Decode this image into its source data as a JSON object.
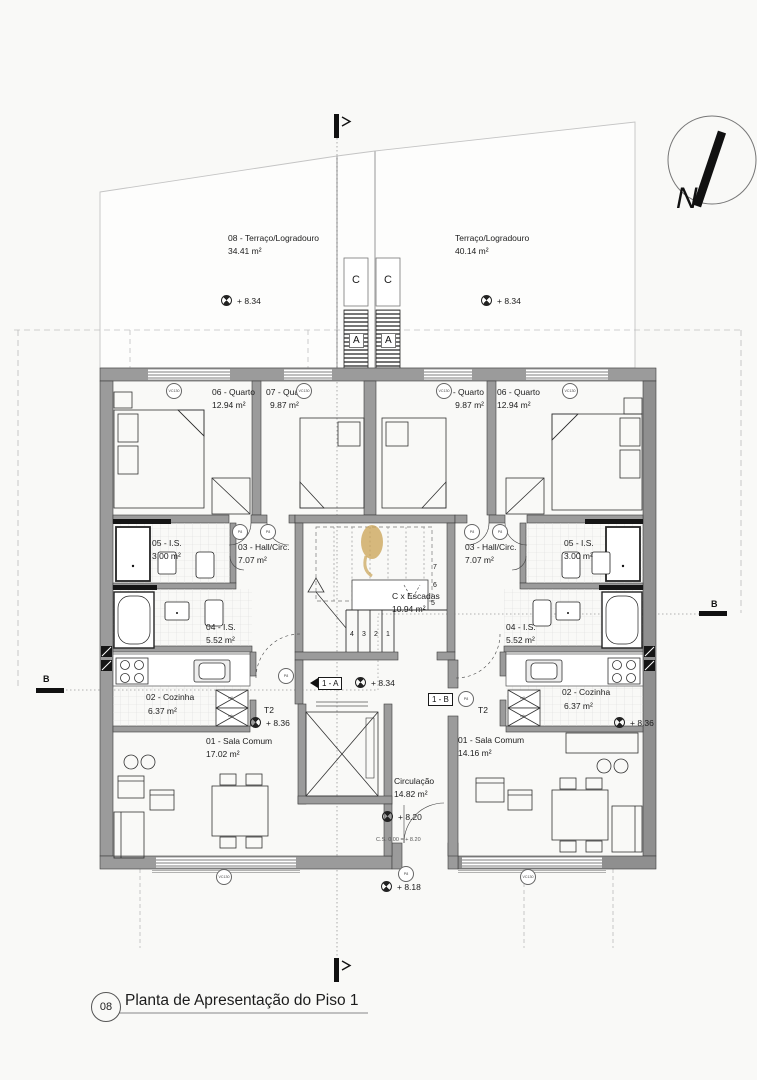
{
  "colors": {
    "wall": "#9b9b9b",
    "wall_dark": "#858585",
    "line": "#222222",
    "light": "#c4c4c4",
    "watermark": "#c9a253",
    "bg": "#f9f9f7"
  },
  "title_block": {
    "number": "08",
    "title": "Planta de Apresentação do Piso 1"
  },
  "north": {
    "label": "N"
  },
  "terraces": {
    "left": {
      "name": "08 - Terraço/Logradouro",
      "area": "34.41 m²",
      "elevation": "+ 8.34"
    },
    "right": {
      "name": "Terraço/Logradouro",
      "area": "40.14 m²",
      "elevation": "+ 8.34"
    }
  },
  "core": {
    "shaft_left": "C",
    "shaft_right": "C",
    "duct_left": "A",
    "duct_right": "A",
    "stairs": {
      "name": "C x Escadas",
      "area": "10.94 m²",
      "steps_bottom": [
        "4",
        "3",
        "2",
        "1"
      ],
      "steps_right": [
        "7",
        "6",
        "5"
      ]
    },
    "landing": {
      "label_a": "1 - A",
      "elevation": "+ 8.34",
      "label_b": "1 - B"
    },
    "circulation": {
      "name": "Circulação",
      "area": "14.82 m²",
      "elevation": "+ 8.20",
      "note": "C.S. 0.00 = + 8.20"
    },
    "outside_elevation": "+ 8.18"
  },
  "unit_left": {
    "type": "T2",
    "entry_elevation": "+ 8.36",
    "rooms": {
      "bedroom1": {
        "name": "06 - Quarto",
        "area": "12.94 m²"
      },
      "bedroom2": {
        "name": "07 - Quarto",
        "area": "9.87 m²"
      },
      "wc_small": {
        "name": "05 - I.S.",
        "area": "3.00 m²"
      },
      "hall": {
        "name": "03 - Hall/Circ.",
        "area": "7.07 m²"
      },
      "wc_main": {
        "name": "04 - I.S.",
        "area": "5.52 m²"
      },
      "kitchen": {
        "name": "02 - Cozinha",
        "area": "6.37 m²"
      },
      "living": {
        "name": "01 - Sala Comum",
        "area": "17.02 m²"
      }
    }
  },
  "unit_right": {
    "type": "T2",
    "entry_elevation": "+ 8.36",
    "rooms": {
      "bedroom1": {
        "name": "06 - Quarto",
        "area": "12.94 m²"
      },
      "bedroom2": {
        "name": "07 - Quarto",
        "area": "9.87 m²"
      },
      "wc_small": {
        "name": "05 - I.S.",
        "area": "3.00 m²"
      },
      "hall": {
        "name": "03 - Hall/Circ.",
        "area": "7.07 m²"
      },
      "wc_main": {
        "name": "04 - I.S.",
        "area": "5.52 m²"
      },
      "kitchen": {
        "name": "02 - Cozinha",
        "area": "6.37 m²"
      },
      "living": {
        "name": "01 - Sala Comum",
        "area": "14.16 m²"
      }
    }
  },
  "section_marks": {
    "left_label": "B",
    "right_label": "B"
  },
  "markers": {
    "window": "VC130",
    "door": "P8",
    "appliance_top": "mll",
    "appliance_bottom": "mlr"
  }
}
